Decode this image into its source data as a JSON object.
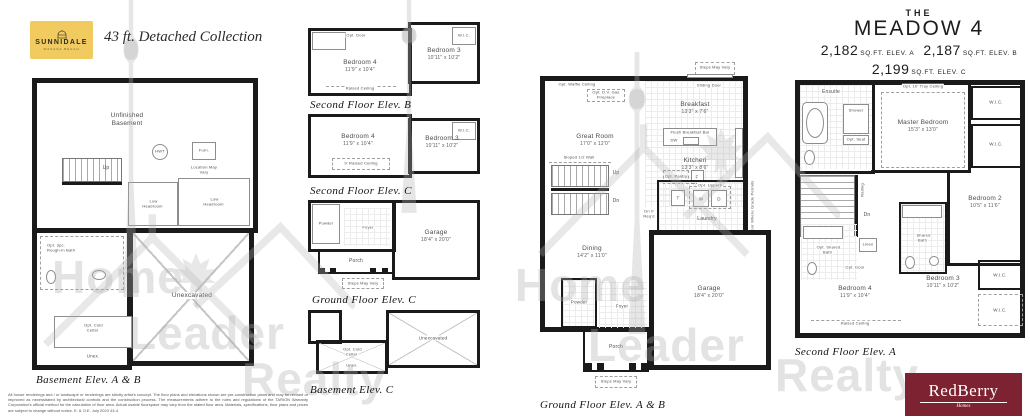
{
  "header": {
    "logo_name": "SUNNIDALE",
    "logo_tagline": "WASAGA BEACH",
    "collection": "43 ft. Detached Collection"
  },
  "title_block": {
    "the": "THE",
    "model": "MEADOW 4",
    "sqft": [
      {
        "value": "2,182",
        "label": "SQ.FT. ELEV. A"
      },
      {
        "value": "2,187",
        "label": "SQ.FT. ELEV. B"
      },
      {
        "value": "2,199",
        "label": "SQ.FT. ELEV. C"
      }
    ]
  },
  "watermark": {
    "home": "Home",
    "leader": "Leader",
    "realty": "Realty"
  },
  "footer": {
    "disclaimer": "All house renderings and / or landscape or renderings are strictly artist's concept. The floor plans and elevations shown are pre-construction plans and may be revised or improved as necessitated by architectural controls and the construction process. The measurements adhere to the rules and regulations of the TARION Warranty Corporation's official method for the calculation of floor area. Actual usable floorspace may vary from the stated floor area. Materials, specifications, floor plans and prices are subject to change without notice. E. & O.E. July 2023 43-4",
    "brand": "RedBerry",
    "brand_tagline": "Homes"
  },
  "basement_ab": {
    "caption": "Basement Elev. A & B",
    "labels": {
      "unfinished": "Unfinished Basement",
      "up": "Up",
      "hwt": "HWT",
      "furn": "Furn.",
      "furn_note": "Location May Vary",
      "low_headroom": "Low Headroom",
      "rough_in": "Opt. 3pc. Rough-in Bath",
      "cold_cellar": "Opt. Cold Cellar",
      "unex": "Unex.",
      "unexcavated": "Unexcavated"
    }
  },
  "second_b": {
    "caption": "Second Floor Elev. B",
    "labels": {
      "bedroom4": "Bedroom 4",
      "bedroom4_dim": "11'9\" x 10'4\"",
      "bedroom3": "Bedroom 3",
      "bedroom3_dim": "10'11\" x 10'2\"",
      "wic": "W.I.C.",
      "opt_door": "Opt. Door",
      "raised": "Raised Ceiling"
    }
  },
  "second_c": {
    "caption": "Second Floor Elev. C",
    "labels": {
      "bedroom4": "Bedroom 4",
      "bedroom4_dim": "11'9\" x 10'4\"",
      "bedroom3": "Bedroom 3",
      "bedroom3_dim": "10'11\" x 10'2\"",
      "wic": "W.I.C.",
      "raised": "9' Raised Ceiling"
    }
  },
  "ground_c": {
    "caption": "Ground Floor Elev. C",
    "labels": {
      "powder": "Powder",
      "foyer": "Foyer",
      "porch": "Porch",
      "garage": "Garage",
      "garage_dim": "18'4\" x 20'0\"",
      "steps": "Steps May Vary"
    }
  },
  "basement_c": {
    "caption": "Basement Elev. C",
    "labels": {
      "unexcavated": "Unexcavated",
      "cold_cellar": "Opt. Cold Cellar",
      "unex": "Unex."
    }
  },
  "ground_ab": {
    "caption": "Ground Floor Elev. A & B",
    "labels": {
      "steps": "Steps May Vary",
      "sliding_door": "Sliding Door",
      "waffle": "Opt. Waffle Ceiling",
      "fireplace": "Opt. D.V. Gas Fireplace",
      "great_room": "Great Room",
      "great_room_dim": "17'0\" x 12'0\"",
      "breakfast": "Breakfast",
      "breakfast_dim": "13'3\" x 7'6\"",
      "kitchen": "Kitchen",
      "kitchen_dim": "13'3\" x 8'6\"",
      "flush_bar": "Flush Breakfast Bar",
      "dw": "DW",
      "f": "F",
      "t": "T",
      "w": "W",
      "d": "D",
      "pantry": "Opt. Pantry",
      "uppers": "Opt. Uppers",
      "sloped": "Sloped 1/2 Wall",
      "up": "Up",
      "dn": "Dn",
      "dn_reqd": "Dn If Req'd",
      "laundry": "Laundry",
      "opt_door_grade": "Opt. Door Where Grade Permits",
      "dining": "Dining",
      "dining_dim": "14'2\" x 11'0\"",
      "garage": "Garage",
      "garage_dim": "18'4\" x 20'0\"",
      "powder": "Powder",
      "foyer": "Foyer",
      "porch": "Porch"
    }
  },
  "second_a": {
    "caption": "Second Floor Elev. A",
    "labels": {
      "ensuite": "Ensuite",
      "shower": "Shower",
      "opt_seat": "Opt. Seat",
      "tray": "Opt. 10' Tray Ceiling",
      "master": "Master Bedroom",
      "master_dim": "15'3\" x 13'0\"",
      "wic": "W.I.C.",
      "railing": "Railing",
      "dn": "Dn",
      "linen": "Linen",
      "opt_shared_bath": "Opt. Shared Bath",
      "shared_bath": "Shared Bath",
      "opt_door": "Opt. Door",
      "bedroom2": "Bedroom 2",
      "bedroom2_dim": "10'5\" x 11'6\"",
      "bedroom3": "Bedroom 3",
      "bedroom3_dim": "10'11\" x 10'2\"",
      "bedroom4": "Bedroom 4",
      "bedroom4_dim": "11'9\" x 10'4\"",
      "raised": "Raised Ceiling"
    }
  },
  "colors": {
    "logo_bg": "#F1CB5F",
    "brand_bg": "#7C2230",
    "wall": "#1A1A1A",
    "watermark": "#ADADAD"
  }
}
